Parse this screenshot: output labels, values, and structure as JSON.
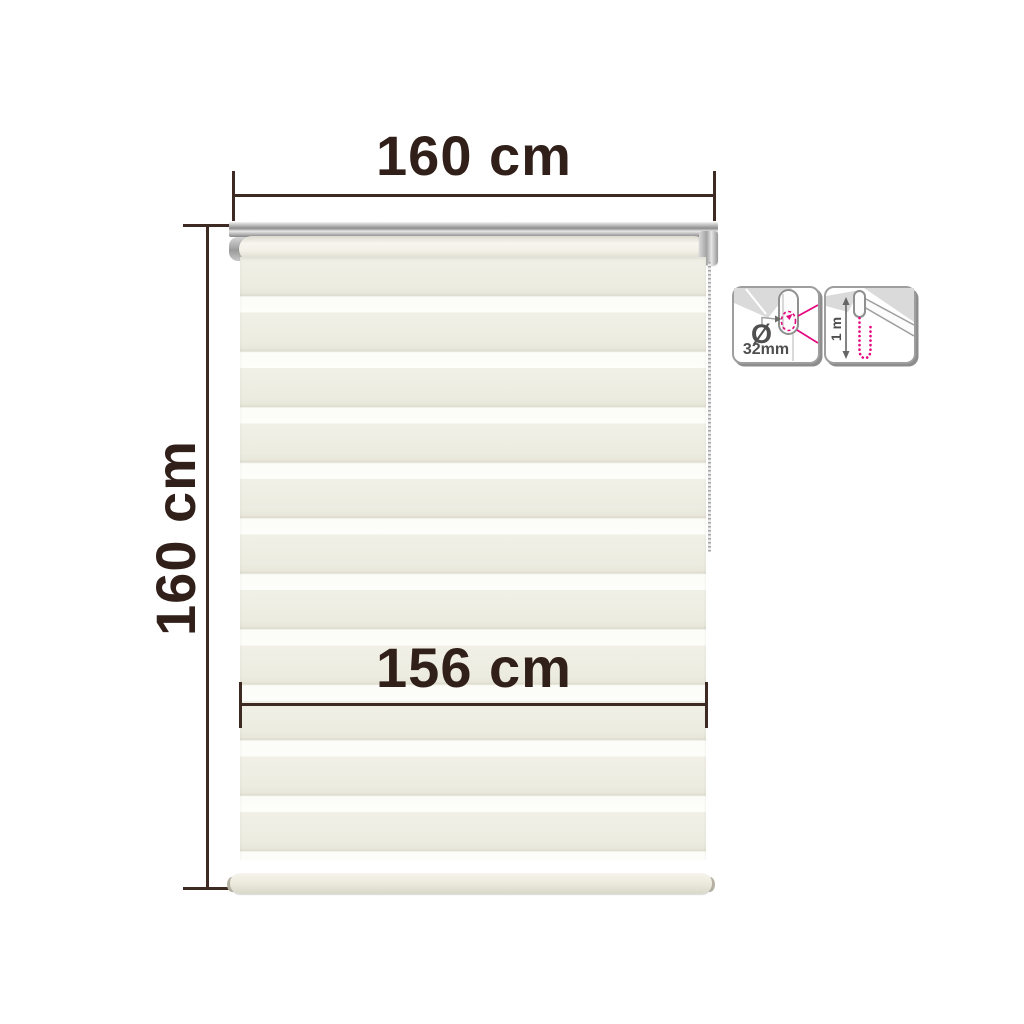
{
  "diagram": {
    "width_label": "160 cm",
    "height_label": "160 cm",
    "fabric_width_label": "156 cm"
  },
  "badges": {
    "tube_diameter": {
      "symbol": "Ø",
      "value": "32mm"
    },
    "chain_length": {
      "value": "1 m"
    }
  },
  "colors": {
    "ink": "#31201a",
    "ink_line": "#3c2a23",
    "magenta": "#e5077e",
    "stripe_cream": "#f1f0e7",
    "stripe_sheer": "#fdfdfa",
    "silver": "#a9a9a9",
    "icon_border": "#9e9e9e",
    "icon_ink": "#4f4f4f"
  }
}
